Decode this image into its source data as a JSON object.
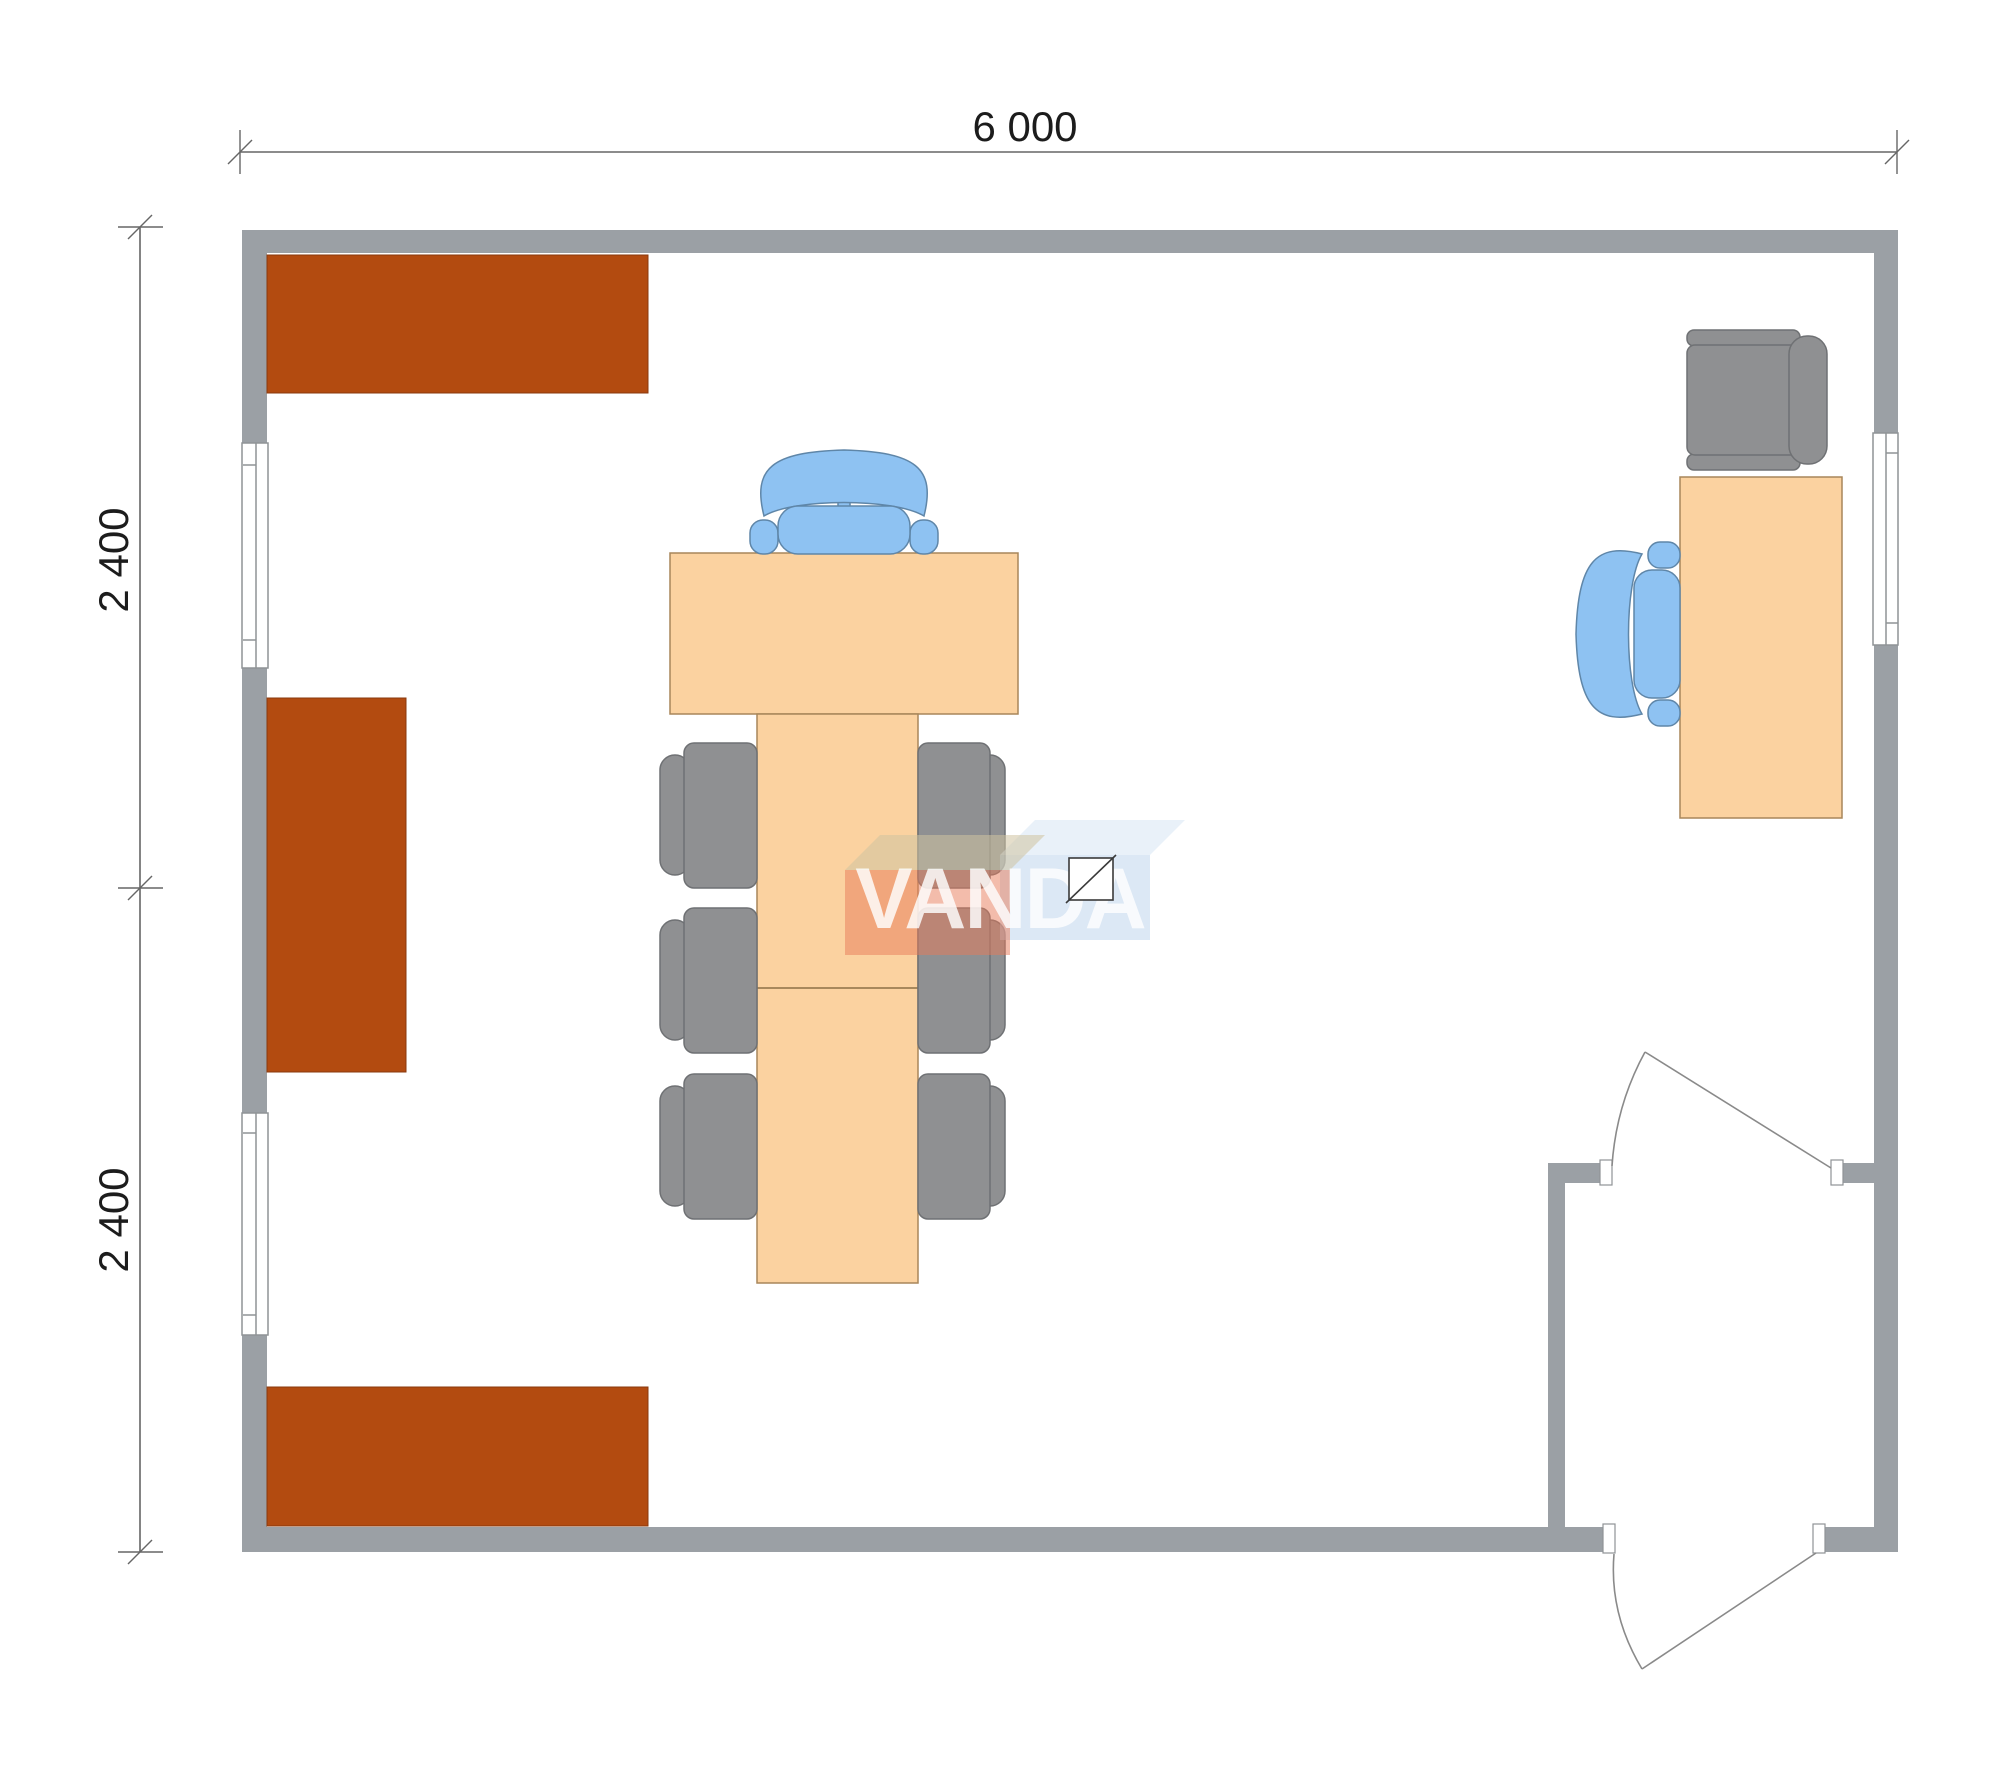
{
  "dimensions": {
    "width_label": "6 000",
    "left_top_label": "2 400",
    "left_bottom_label": "2 400"
  },
  "watermark": {
    "text": "VANDA"
  },
  "colors": {
    "wall": "#9ba0a5",
    "cabinet": "#b34b10",
    "table": "#fbd2a0",
    "chair_gray": "#8f9092",
    "chair_blue": "#8ec2f2",
    "dimension_line": "#666666",
    "dimension_text": "#1c1c1c",
    "door_line": "#8a8a8a",
    "watermark_orange_front": "#e87a58",
    "watermark_orange_top": "#cfc3a0",
    "watermark_blue_front": "#b9d2ec",
    "watermark_blue_top": "#d7e6f4",
    "watermark_text_color": "#ffffff",
    "symbol_fill": "#ffffff"
  },
  "plan": {
    "building_width_mm": 6000,
    "building_depth_mm": 4800,
    "depth_bays_mm": [
      2400,
      2400
    ],
    "rooms": [
      "main office room",
      "entrance vestibule"
    ],
    "furniture": [
      {
        "item": "cabinet",
        "location": "top-left along top wall"
      },
      {
        "item": "cabinet",
        "location": "middle of left wall"
      },
      {
        "item": "cabinet",
        "location": "bottom-left along bottom wall"
      },
      {
        "item": "meeting table with executive chair and six side chairs",
        "location": "center"
      },
      {
        "item": "desk with office chair and visitor armchair",
        "location": "right wall"
      }
    ],
    "openings": [
      "window upper left wall",
      "window lower left wall",
      "window right wall",
      "interior door from main room to vestibule",
      "exterior door at bottom right, swings outward"
    ]
  }
}
